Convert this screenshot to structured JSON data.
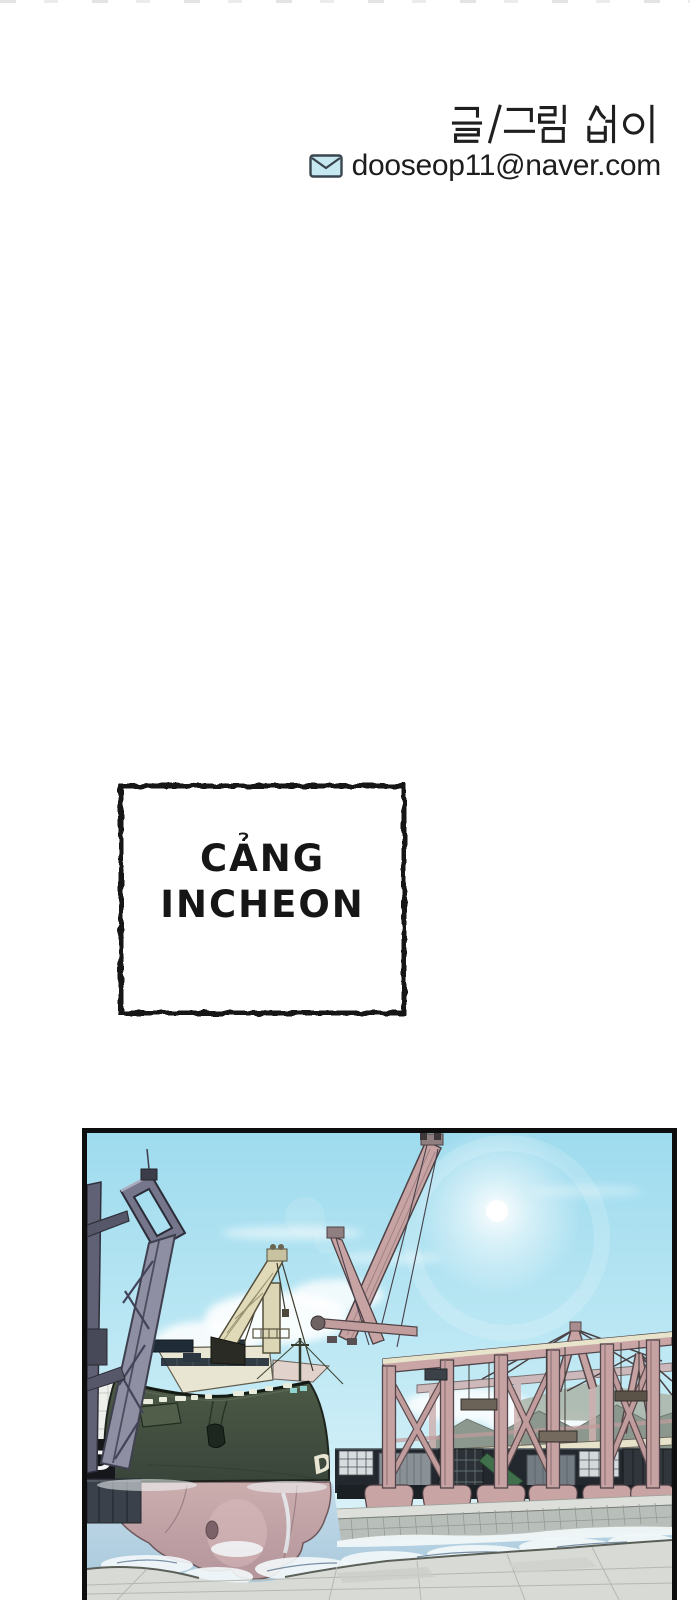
{
  "page": {
    "background": "#ffffff"
  },
  "credits": {
    "byline": "글 /그림 섭이",
    "email": "dooseop11@naver.com"
  },
  "caption_box": {
    "line1": "CẢNG",
    "line2": "INCHEON"
  },
  "panel": {
    "hull_text": "DC",
    "dock_sign_text": "D",
    "description": "Incheon container port: green ship bow with deck crane, pink gantry cranes, containers, quay and water",
    "colors": {
      "sky_top": "#9edbee",
      "sky_horizon": "#eaf7fb",
      "crane_pink": "#c6a2a3",
      "beam_cream": "#e7e3ca",
      "hull_green": "#47533f",
      "hull_bottom_pink": "#c4a1a5",
      "water": "#b7d3e2",
      "foam": "#f3f8fa",
      "pier": "#d8dad6",
      "dark_crane": "#8e8fa2",
      "panel_border": "#0e0e0e",
      "email_icon_fill": "#c6e8f1"
    }
  }
}
